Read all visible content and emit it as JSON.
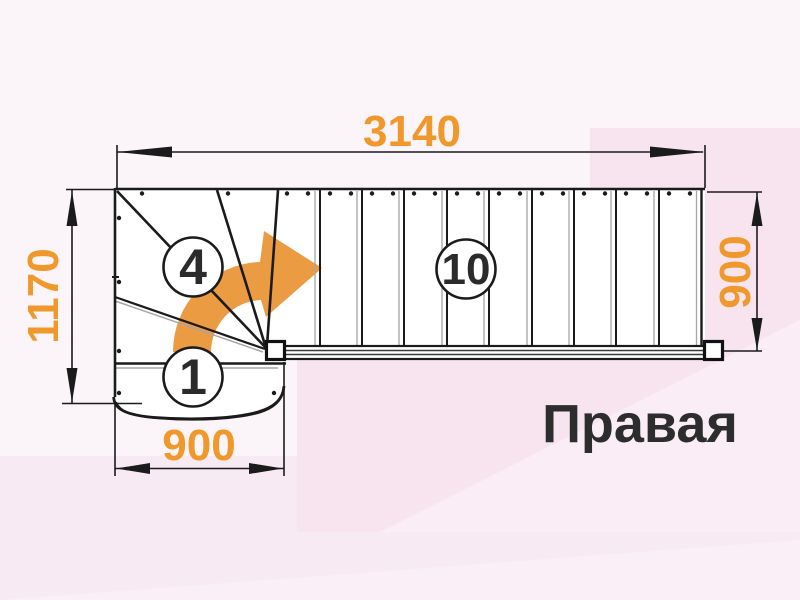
{
  "title": "Правая",
  "drawing": "staircase-plan-top-view",
  "dimensions": {
    "top_width": "3140",
    "left_height": "1170",
    "bottom_width": "900",
    "right_height": "900"
  },
  "step_labels": {
    "first_step": "1",
    "winder_step": "4",
    "straight_step": "10"
  },
  "colors": {
    "dimension_text": "#F0982B",
    "arrow": "#EB9B42",
    "line": "#1B1B1B",
    "label_text": "#2D2D2D",
    "background": "#FBF4F8",
    "background_pink": "#F7E4EF"
  }
}
